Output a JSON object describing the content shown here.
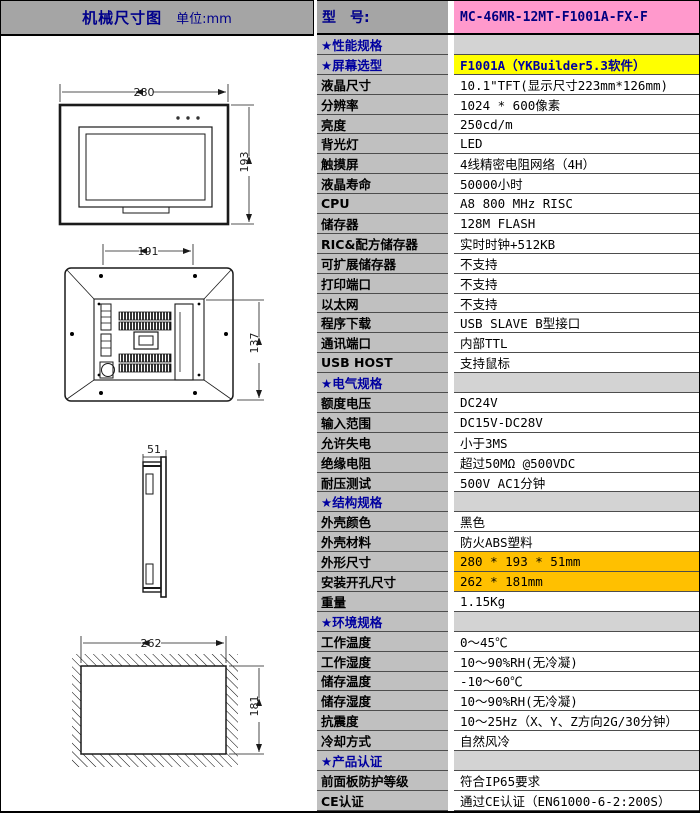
{
  "header": {
    "left_title": "机械尺寸图",
    "left_unit": "单位:mm",
    "model_label": "型　号:",
    "model_value": "MC-46MR-12MT-F1001A-FX-F"
  },
  "colors": {
    "title_bar_gray": "#a5a5a5",
    "label_cell_gray": "#c0c0c0",
    "section_value_gray": "#d3d3d3",
    "model_pink": "#ff99cc",
    "highlight_yellow": "#ffff00",
    "highlight_orange": "#ffc000",
    "navy_text": "#000080"
  },
  "drawings": {
    "front_view": {
      "width_mm": "280",
      "height_mm": "193"
    },
    "rear_view": {
      "width_mm": "191",
      "height_mm": "137"
    },
    "side_view": {
      "depth_mm": "51"
    },
    "panel_cutout": {
      "width_mm": "262",
      "height_mm": "181"
    }
  },
  "spec_rows": [
    {
      "type": "section",
      "label": "★性能规格",
      "value": ""
    },
    {
      "type": "row",
      "label": "★屏幕选型",
      "label_blue": true,
      "value": "F1001A（YKBuilder5.3软件）",
      "value_bg": "yellow"
    },
    {
      "type": "row",
      "label": "液晶尺寸",
      "value": "10.1\"TFT(显示尺寸223mm*126mm)"
    },
    {
      "type": "row",
      "label": "分辨率",
      "value": "1024 * 600像素"
    },
    {
      "type": "row",
      "label": "亮度",
      "value": "250cd/m"
    },
    {
      "type": "row",
      "label": "背光灯",
      "value": "LED"
    },
    {
      "type": "row",
      "label": "触摸屏",
      "value": "4线精密电阻网络（4H）"
    },
    {
      "type": "row",
      "label": "液晶寿命",
      "value": "50000小时"
    },
    {
      "type": "row",
      "label": "CPU",
      "value": "A8 800 MHz RISC"
    },
    {
      "type": "row",
      "label": "储存器",
      "value": "128M FLASH"
    },
    {
      "type": "row",
      "label": "RIC&配方储存器",
      "value": "实时时钟+512KB"
    },
    {
      "type": "row",
      "label": "可扩展储存器",
      "value": "不支持"
    },
    {
      "type": "row",
      "label": "打印端口",
      "value": "不支持"
    },
    {
      "type": "row",
      "label": "以太网",
      "value": "不支持"
    },
    {
      "type": "row",
      "label": "程序下载",
      "value": "USB SLAVE B型接口"
    },
    {
      "type": "row",
      "label": "通讯端口",
      "value": "内部TTL"
    },
    {
      "type": "row",
      "label": "USB HOST",
      "value": "支持鼠标"
    },
    {
      "type": "section",
      "label": "★电气规格",
      "value": ""
    },
    {
      "type": "row",
      "label": "额度电压",
      "value": "DC24V"
    },
    {
      "type": "row",
      "label": "输入范围",
      "value": "DC15V-DC28V"
    },
    {
      "type": "row",
      "label": "允许失电",
      "value": "小于3MS"
    },
    {
      "type": "row",
      "label": "绝缘电阻",
      "value": "超过50MΩ @500VDC"
    },
    {
      "type": "row",
      "label": "耐压测试",
      "value": "500V AC1分钟"
    },
    {
      "type": "section",
      "label": "★结构规格",
      "value": ""
    },
    {
      "type": "row",
      "label": "外壳颜色",
      "value": "黑色"
    },
    {
      "type": "row",
      "label": "外壳材料",
      "value": "防火ABS塑料"
    },
    {
      "type": "row",
      "label": "外形尺寸",
      "value": "280 * 193 * 51mm",
      "value_bg": "orange"
    },
    {
      "type": "row",
      "label": "安装开孔尺寸",
      "value": "262 * 181mm",
      "value_bg": "orange"
    },
    {
      "type": "row",
      "label": "重量",
      "value": "1.15Kg"
    },
    {
      "type": "section",
      "label": "★环境规格",
      "value": ""
    },
    {
      "type": "row",
      "label": "工作温度",
      "value": "0～45℃"
    },
    {
      "type": "row",
      "label": "工作湿度",
      "value": "10～90%RH(无冷凝)"
    },
    {
      "type": "row",
      "label": "储存温度",
      "value": "-10～60℃"
    },
    {
      "type": "row",
      "label": "储存湿度",
      "value": "10～90%RH(无冷凝)"
    },
    {
      "type": "row",
      "label": "抗震度",
      "value": "10～25Hz（X、Y、Z方向2G/30分钟）"
    },
    {
      "type": "row",
      "label": "冷却方式",
      "value": "自然风冷"
    },
    {
      "type": "section",
      "label": "★产品认证",
      "value": ""
    },
    {
      "type": "row",
      "label": "前面板防护等级",
      "value": "符合IP65要求"
    },
    {
      "type": "row",
      "label": "CE认证",
      "value": "通过CE认证（EN61000-6-2:200S）"
    }
  ]
}
